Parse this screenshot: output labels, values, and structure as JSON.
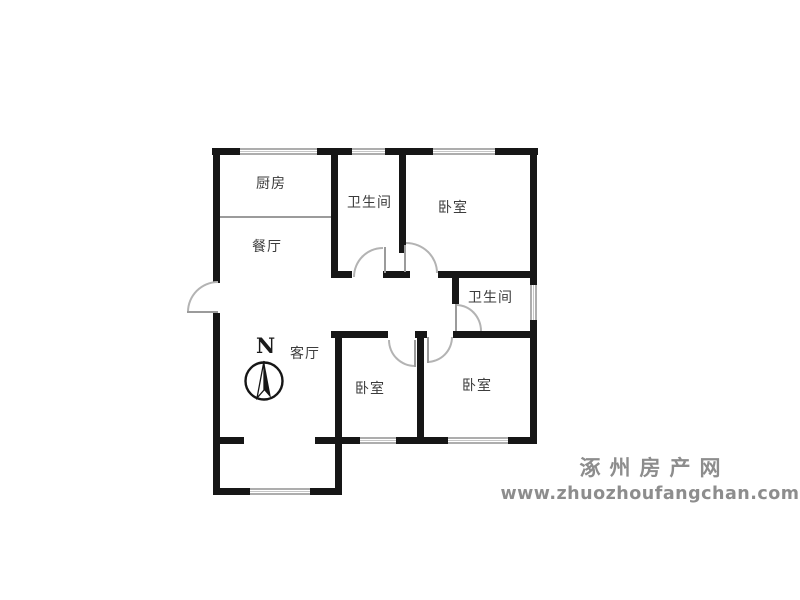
{
  "plan": {
    "rooms": {
      "kitchen": {
        "label": "厨房"
      },
      "dining": {
        "label": "餐厅"
      },
      "living": {
        "label": "客厅"
      },
      "bathroom_top": {
        "label": "卫生间"
      },
      "bathroom_right": {
        "label": "卫生间"
      },
      "bedroom_top_right": {
        "label": "卧室"
      },
      "bedroom_bottom_middle": {
        "label": "卧室"
      },
      "bedroom_bottom_right": {
        "label": "卧室"
      }
    },
    "compass": {
      "north_label": "N"
    },
    "colors": {
      "wall": "#161616",
      "door_arc": "#b3b3b3",
      "window_line": "#adadad",
      "label_text": "#3c3c3c"
    }
  },
  "watermark": {
    "site_name": "涿州房产网",
    "site_url": "www.zhuozhoufangchan.com",
    "color": "#8d8d8d"
  }
}
